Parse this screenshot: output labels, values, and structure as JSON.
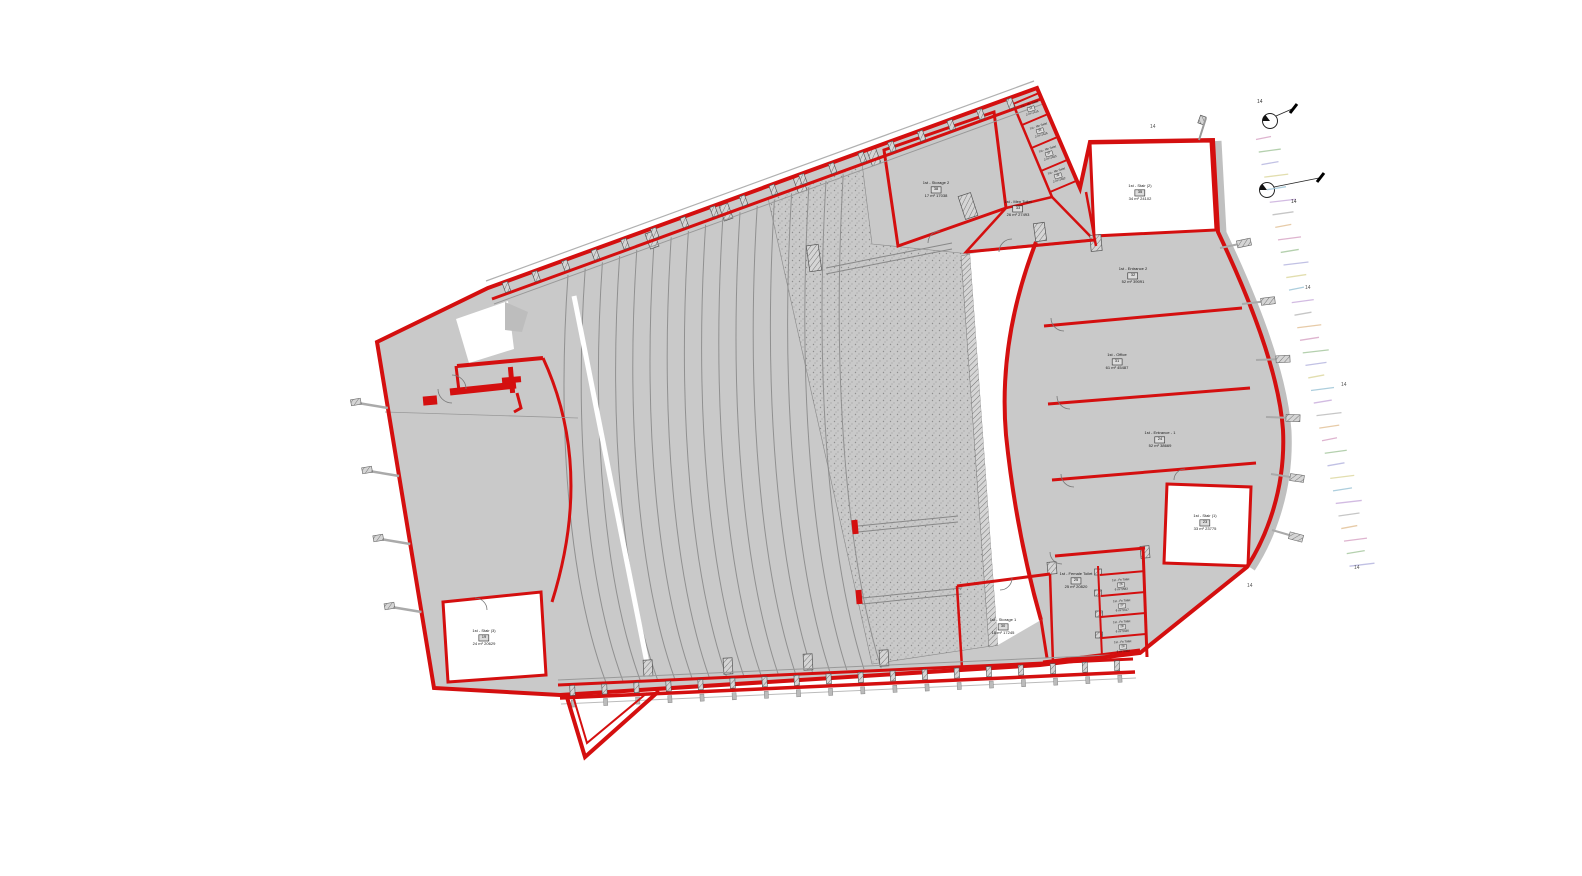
{
  "plan": {
    "colors": {
      "wall_red": "#d40f0f",
      "floor_gray": "#c9c9c9",
      "row_line_gray": "#909090",
      "annotation_gray": "#555555",
      "background": "#ffffff"
    },
    "seating_row_count": 17,
    "level_mark_label": "14",
    "level_marks": [
      {
        "x": 1150,
        "y": 128
      },
      {
        "x": 1305,
        "y": 289
      },
      {
        "x": 1341,
        "y": 386
      },
      {
        "x": 1247,
        "y": 587
      },
      {
        "x": 1354,
        "y": 569
      }
    ],
    "section_markers": [
      {
        "label": "14",
        "x": 1257,
        "y": 103
      },
      {
        "label": "14",
        "x": 1291,
        "y": 203
      }
    ],
    "dash_palette": [
      "#d9a7c7",
      "#a8c8a0",
      "#b7b7e0",
      "#ded9a2",
      "#9fc6d8",
      "#cbb0dd",
      "#bdbdbd",
      "#e3c39a"
    ],
    "rooms": [
      {
        "id": "storage-2",
        "name": "1st - Storage 2",
        "num": "38",
        "area": "17 m² 17038",
        "x": 936,
        "y": 190,
        "rot": 0,
        "small": false
      },
      {
        "id": "men-toilet",
        "name": "1st - Men Toilet",
        "num": "33",
        "area": "26 m² 27493",
        "x": 1018,
        "y": 209,
        "rot": 0,
        "small": false
      },
      {
        "id": "me-toilet-1",
        "name": "1st - Me Toilet",
        "num": "34",
        "area": "2 m² 2415",
        "x": 1031,
        "y": 109,
        "rot": -18,
        "small": true
      },
      {
        "id": "me-toilet-2",
        "name": "1st - Me Toilet",
        "num": "36",
        "area": "2 m² 2426",
        "x": 1040,
        "y": 131,
        "rot": -18,
        "small": true
      },
      {
        "id": "me-toilet-3",
        "name": "1st - Me Toilet",
        "num": "37",
        "area": "2 m² 2453",
        "x": 1049,
        "y": 154,
        "rot": -18,
        "small": true
      },
      {
        "id": "me-toilet-4",
        "name": "1st - Me Toilet",
        "num": "39",
        "area": "2 m² 2452",
        "x": 1058,
        "y": 176,
        "rot": -18,
        "small": true
      },
      {
        "id": "stair-2",
        "name": "1st - Stair (2)",
        "num": "35",
        "area": "34 m² 24102",
        "x": 1140,
        "y": 193,
        "rot": 0,
        "small": false
      },
      {
        "id": "entrance-2",
        "name": "1st - Entrance 2",
        "num": "32",
        "area": "52 m² 39091",
        "x": 1133,
        "y": 276,
        "rot": 0,
        "small": false
      },
      {
        "id": "office",
        "name": "1st - Office",
        "num": "31",
        "area": "61 m² 45487",
        "x": 1117,
        "y": 362,
        "rot": 0,
        "small": false
      },
      {
        "id": "entrance-1",
        "name": "1st - Entrance - 1",
        "num": "24",
        "area": "52 m² 38669",
        "x": 1160,
        "y": 440,
        "rot": 0,
        "small": false
      },
      {
        "id": "stair-1",
        "name": "1st - Stair (1)",
        "num": "23",
        "area": "33 m² 23775",
        "x": 1205,
        "y": 523,
        "rot": 0,
        "small": false
      },
      {
        "id": "female-toilet",
        "name": "1st - Female Toilet",
        "num": "25",
        "area": "25 m² 20820",
        "x": 1076,
        "y": 581,
        "rot": 0,
        "small": false
      },
      {
        "id": "fe-toilet-1",
        "name": "1st - Fe Toilet",
        "num": "26",
        "area": "6 m² 5583",
        "x": 1121,
        "y": 585,
        "rot": -4,
        "small": true
      },
      {
        "id": "fe-toilet-2",
        "name": "1st - Fe Toilet",
        "num": "27",
        "area": "6 m² 5417",
        "x": 1122,
        "y": 606,
        "rot": -4,
        "small": true
      },
      {
        "id": "fe-toilet-3",
        "name": "1st - Fe Toilet",
        "num": "28",
        "area": "6 m² 5436",
        "x": 1122,
        "y": 627,
        "rot": -4,
        "small": true
      },
      {
        "id": "fe-toilet-4",
        "name": "1st - Fe Toilet",
        "num": "29",
        "area": "6 m² 5452",
        "x": 1123,
        "y": 647,
        "rot": -4,
        "small": true
      },
      {
        "id": "storage-1",
        "name": "1st - Storage 1",
        "num": "30",
        "area": "18 m² 17245",
        "x": 1003,
        "y": 627,
        "rot": 0,
        "small": false
      },
      {
        "id": "stair-3",
        "name": "1st - Stair (3)",
        "num": "19",
        "area": "24 m² 20629",
        "x": 484,
        "y": 638,
        "rot": 0,
        "small": false
      }
    ]
  }
}
